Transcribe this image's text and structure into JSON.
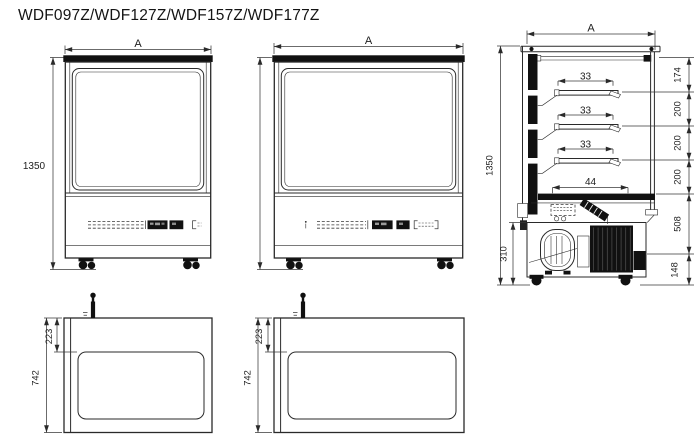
{
  "title": "WDF097Z/WDF127Z/WDF157Z/WDF177Z",
  "views": {
    "front_narrow": {
      "width_label": "A",
      "height_label": "1350"
    },
    "front_wide": {
      "width_label": "A"
    },
    "side": {
      "width_label": "A",
      "height_label": "1350",
      "shelf_depths": [
        "33",
        "33",
        "33"
      ],
      "deck_depth": "44",
      "right_chain": [
        "174",
        "200",
        "200",
        "200",
        "508",
        "148"
      ],
      "machine_height": "310"
    },
    "plan_narrow": {
      "back_inset": "223",
      "depth": "742"
    },
    "plan_wide": {
      "back_inset": "223",
      "depth": "742"
    }
  },
  "colors": {
    "line": "#2a2a2a",
    "dark": "#111111",
    "background": "#ffffff"
  }
}
